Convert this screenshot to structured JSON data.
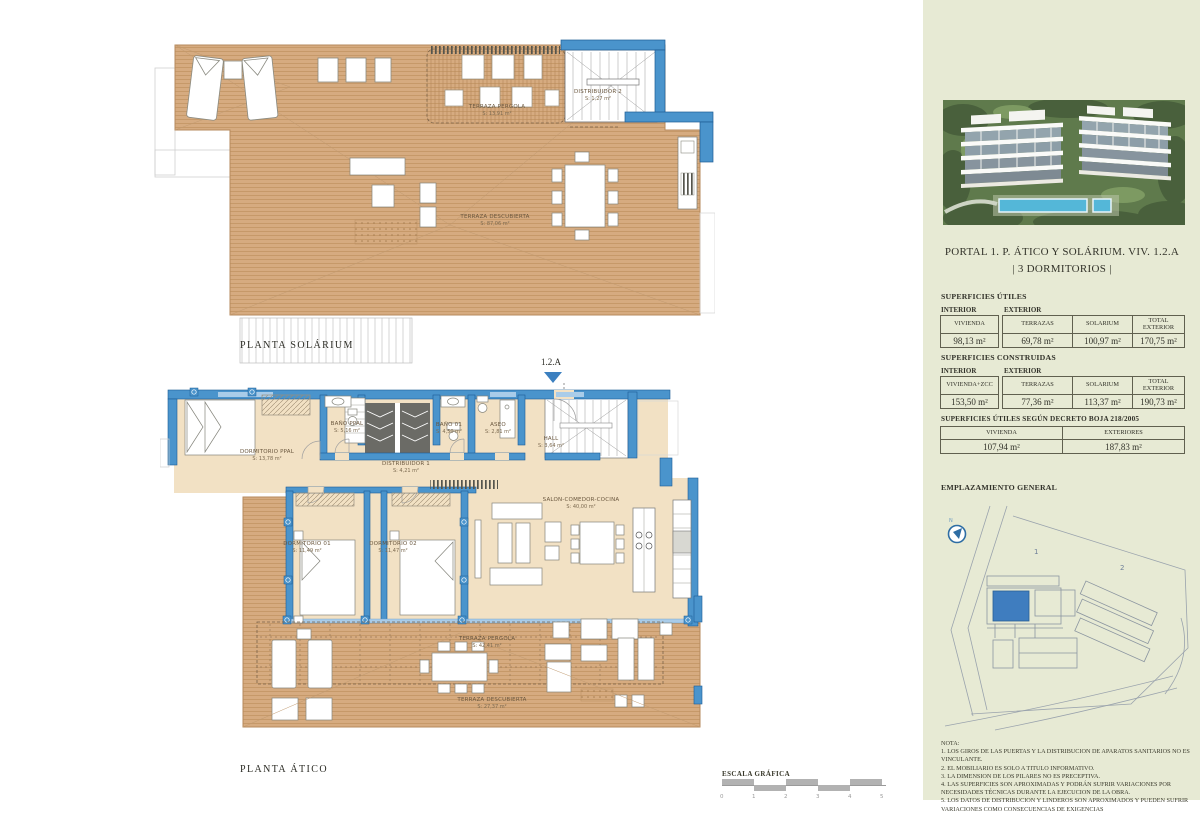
{
  "sheet": {
    "solarium": {
      "title": "PLANTA SOLÁRIUM",
      "labels": {
        "pergola": {
          "name": "TERRAZA PERGOLA",
          "area": "S: 13,91 m²"
        },
        "distribuidor2": {
          "name": "DISTRIBUIDOR 2",
          "area": "S: 1,27 m²"
        },
        "descubierta": {
          "name": "TERRAZA DESCUBIERTA",
          "area": "S: 87,06 m²"
        }
      }
    },
    "atico": {
      "title": "PLANTA ÁTICO",
      "unit_marker": "1.2.A",
      "labels": {
        "dorm_ppal": {
          "name": "DORMITORIO PPAL",
          "area": "S: 13,78 m²"
        },
        "bano_ppal": {
          "name": "BAÑO PPAL",
          "area": "S: 5,16 m²"
        },
        "bano_01": {
          "name": "BAÑO 01",
          "area": "S: 4,50 m²"
        },
        "aseo": {
          "name": "ASEO",
          "area": "S: 2,81 m²"
        },
        "hall": {
          "name": "HALL",
          "area": "S: 3,64 m²"
        },
        "distribuidor1": {
          "name": "DISTRIBUIDOR 1",
          "area": "S: 4,21 m²"
        },
        "dorm_01": {
          "name": "DORMITORIO 01",
          "area": "S: 11,49 m²"
        },
        "dorm_02": {
          "name": "DORMITORIO 02",
          "area": "S: 11,47 m²"
        },
        "salon": {
          "name": "SALON-COMEDOR-COCINA",
          "area": "S: 40,00 m²"
        },
        "terraza_pergola": {
          "name": "TERRAZA PERGOLA",
          "area": "S: 42,41 m²"
        },
        "terraza_descubierta": {
          "name": "TERRAZA DESCUBIERTA",
          "area": "S: 27,37 m²"
        }
      }
    },
    "scale": {
      "label": "ESCALA GRÁFICA",
      "ticks": [
        "0",
        "1",
        "2",
        "3",
        "4",
        "5"
      ]
    }
  },
  "sidebar": {
    "title_line1": "PORTAL 1. P. ÁTICO Y SOLÁRIUM. VIV. 1.2.A",
    "title_line2": "| 3 DORMITORIOS |",
    "utiles": {
      "heading": "SUPERFICIES ÚTILES",
      "group_interior": "INTERIOR",
      "group_exterior": "EXTERIOR",
      "cols": [
        {
          "h": "VIVIENDA",
          "v": "98,13 m²"
        },
        {
          "h": "TERRAZAS",
          "v": "69,78 m²"
        },
        {
          "h": "SOLARIUM",
          "v": "100,97 m²"
        },
        {
          "h": "TOTAL EXTERIOR",
          "v": "170,75 m²"
        }
      ]
    },
    "construidas": {
      "heading": "SUPERFICIES CONSTRUIDAS",
      "group_interior": "INTERIOR",
      "group_exterior": "EXTERIOR",
      "cols": [
        {
          "h": "VIVIENDA+ZCC",
          "v": "153,50 m²"
        },
        {
          "h": "TERRAZAS",
          "v": "77,36 m²"
        },
        {
          "h": "SOLARIUM",
          "v": "113,37 m²"
        },
        {
          "h": "TOTAL EXTERIOR",
          "v": "190,73 m²"
        }
      ]
    },
    "decreto": {
      "heading": "SUPERFICIES ÚTILES SEGÚN DECRETO BOJA 218/2005",
      "cols": [
        {
          "h": "VIVIENDA",
          "v": "107,94 m²"
        },
        {
          "h": "EXTERIORES",
          "v": "187,83 m²"
        }
      ]
    },
    "emplazamiento_heading": "EMPLAZAMIENTO GENERAL",
    "site_plan": {
      "building1_label": "1",
      "building2_label": "2"
    },
    "nota": {
      "lines": [
        "NOTA:",
        "1. LOS GIROS DE LAS PUERTAS Y LA DISTRIBUCION DE APARATOS SANITARIOS NO ES VINCULANTE.",
        "2. EL MOBILIARIO ES SOLO A TITULO INFORMATIVO.",
        "3. LA DIMENSION DE LOS PILARES NO ES PRECEPTIVA.",
        "4. LAS SUPERFICIES SON APROXIMADAS Y PODRÁN SUFRIR VARIACIONES POR NECESIDADES TÉCNICAS DURANTE LA EJECUCION DE LA OBRA.",
        "5. LOS DATOS DE DISTRIBUCION Y LINDEROS SON APROXIMADOS Y PUEDEN SUFRIR VARIACIONES COMO CONSECUENCIAS DE EXIGENCIAS"
      ]
    }
  },
  "colors": {
    "accent_blue": "#4a94cc",
    "deck_tan": "#d6ab80",
    "sidebar_green": "#e7ead4"
  }
}
